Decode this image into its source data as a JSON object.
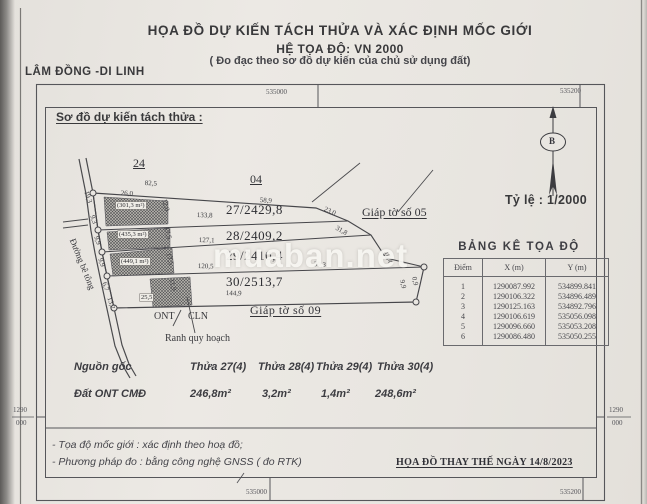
{
  "header": {
    "title": "HỌA ĐỒ DỰ KIẾN TÁCH THỬA VÀ XÁC ĐỊNH MỐC GIỚI",
    "subtitle": "HỆ TỌA ĐỘ: VN 2000",
    "note": "( Đo đạc theo sơ đồ dự kiến của chủ sử dụng đất)",
    "region": "LÂM ĐỒNG -DI LINH"
  },
  "grid": {
    "top_left": "535000",
    "top_right": "535200",
    "bottom_left": "535000",
    "bottom_right": "535200",
    "left_top": "1290",
    "left_bottom": "000",
    "right_top": "1290",
    "right_bottom": "000"
  },
  "sketch": {
    "heading": "Sơ đồ dự kiến tách thửa :",
    "scale_label": "Tỷ lệ : 1/2000",
    "north": "B",
    "sheet_24": "24",
    "sheet_04": "04",
    "adjacent_top": "Giáp tờ số 05",
    "adjacent_bottom": "Giáp tờ số 09",
    "road_label": "Đường bê tông",
    "planning_label": "Ranh quy hoạch",
    "landuse_left": "ONT",
    "landuse_right": "CLN",
    "parcels": [
      "27/2429,8",
      "28/2409,2",
      "29/2410,4",
      "30/2513,7"
    ],
    "hatch_areas": [
      "(301,3 m²)",
      "(435,3 m²)",
      "(449,1 m²)",
      "25,5"
    ],
    "dims": [
      "82,5",
      "26,0",
      "58,9",
      "23,0",
      "133,8",
      "31,8",
      "127,1",
      "120,5",
      "30,3",
      "144,9",
      "19,3",
      "9,3",
      "9,9",
      "9,9",
      "6,7",
      "13,2",
      "12,0",
      "17,5",
      "17,5",
      "11,9",
      "10,4",
      "9,9",
      "0,9"
    ]
  },
  "table": {
    "title": "BẢNG KÊ TỌA ĐỘ",
    "columns": [
      "Điểm",
      "X (m)",
      "Y (m)"
    ],
    "rows": [
      [
        "1",
        "1290087.992",
        "534899.841"
      ],
      [
        "2",
        "1290106.322",
        "534896.489"
      ],
      [
        "3",
        "1290125.163",
        "534892.796"
      ],
      [
        "4",
        "1290106.619",
        "535056.098"
      ],
      [
        "5",
        "1290096.660",
        "535053.208"
      ],
      [
        "6",
        "1290086.480",
        "535050.255"
      ]
    ]
  },
  "origin": {
    "label": "Nguồn gốc",
    "land_label": "Đất ONT CMĐ",
    "cols": [
      "Thửa 27(4)",
      "Thửa 28(4)",
      "Thửa 29(4)",
      "Thửa 30(4)"
    ],
    "areas": [
      "246,8m²",
      "3,2m²",
      "1,4m²",
      "248,6m²"
    ]
  },
  "footer": {
    "note1": "- Tọa độ mốc giới : xác định theo hoạ đồ;",
    "note2": "- Phương pháp đo : bằng công nghệ GNSS ( đo RTK)",
    "replace": "HỌA ĐỒ THAY THẾ NGÀY 14/8/2023"
  },
  "watermark": "muaban.net",
  "colors": {
    "paper": "#e9e6e1",
    "ink": "#3b3b3d"
  }
}
